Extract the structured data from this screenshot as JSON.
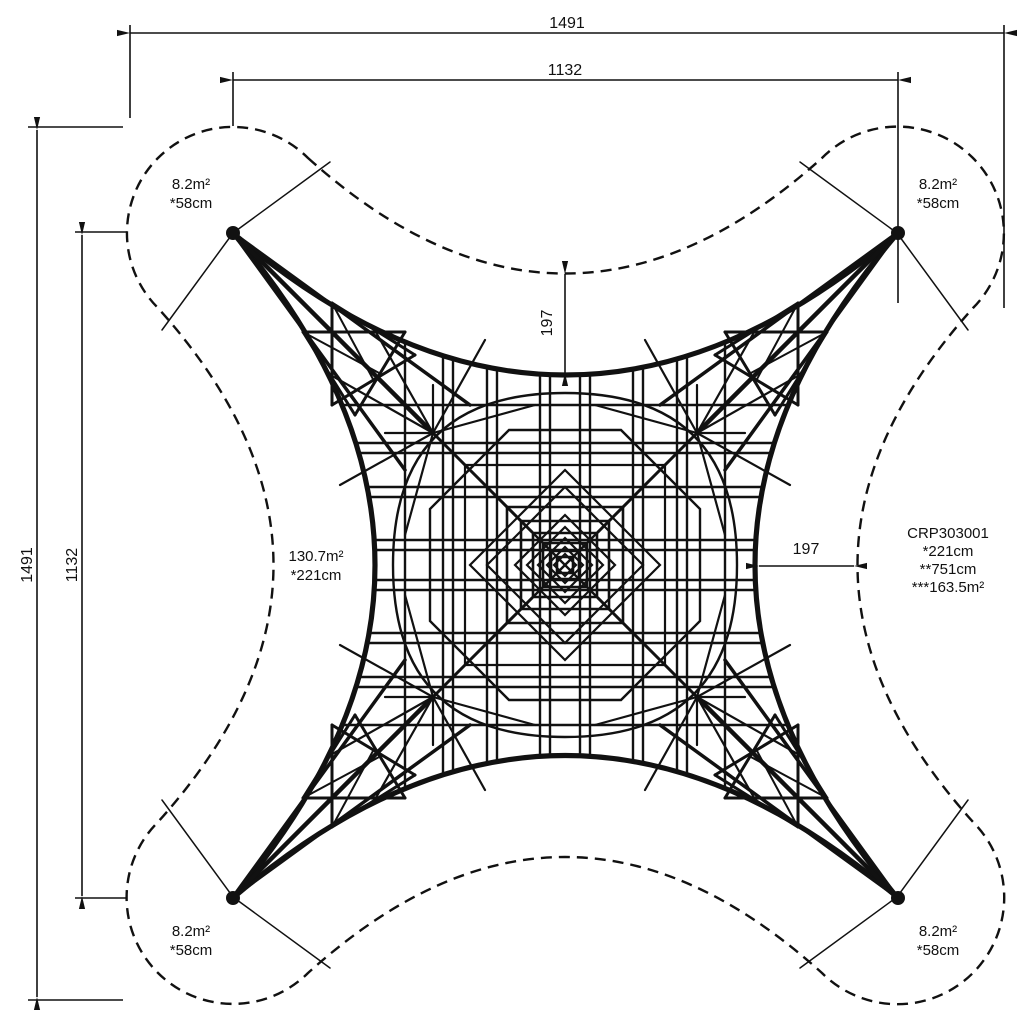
{
  "drawing": {
    "dimensions": {
      "top_outer": "1491",
      "top_inner": "1132",
      "left_outer": "1491",
      "left_inner": "1132",
      "clearance_top": "197",
      "clearance_right": "197"
    },
    "corner_labels": {
      "top_left": {
        "area": "8.2m²",
        "height": "*58cm"
      },
      "top_right": {
        "area": "8.2m²",
        "height": "*58cm"
      },
      "bottom_left": {
        "area": "8.2m²",
        "height": "*58cm"
      },
      "bottom_right": {
        "area": "8.2m²",
        "height": "*58cm"
      }
    },
    "net_label": {
      "area": "130.7m²",
      "height": "*221cm"
    },
    "product_label": {
      "code": "CRP303001",
      "line2": "*221cm",
      "line3": "**751cm",
      "line4": "***163.5m²"
    },
    "colors": {
      "ink": "#111111",
      "background": "#ffffff"
    }
  }
}
